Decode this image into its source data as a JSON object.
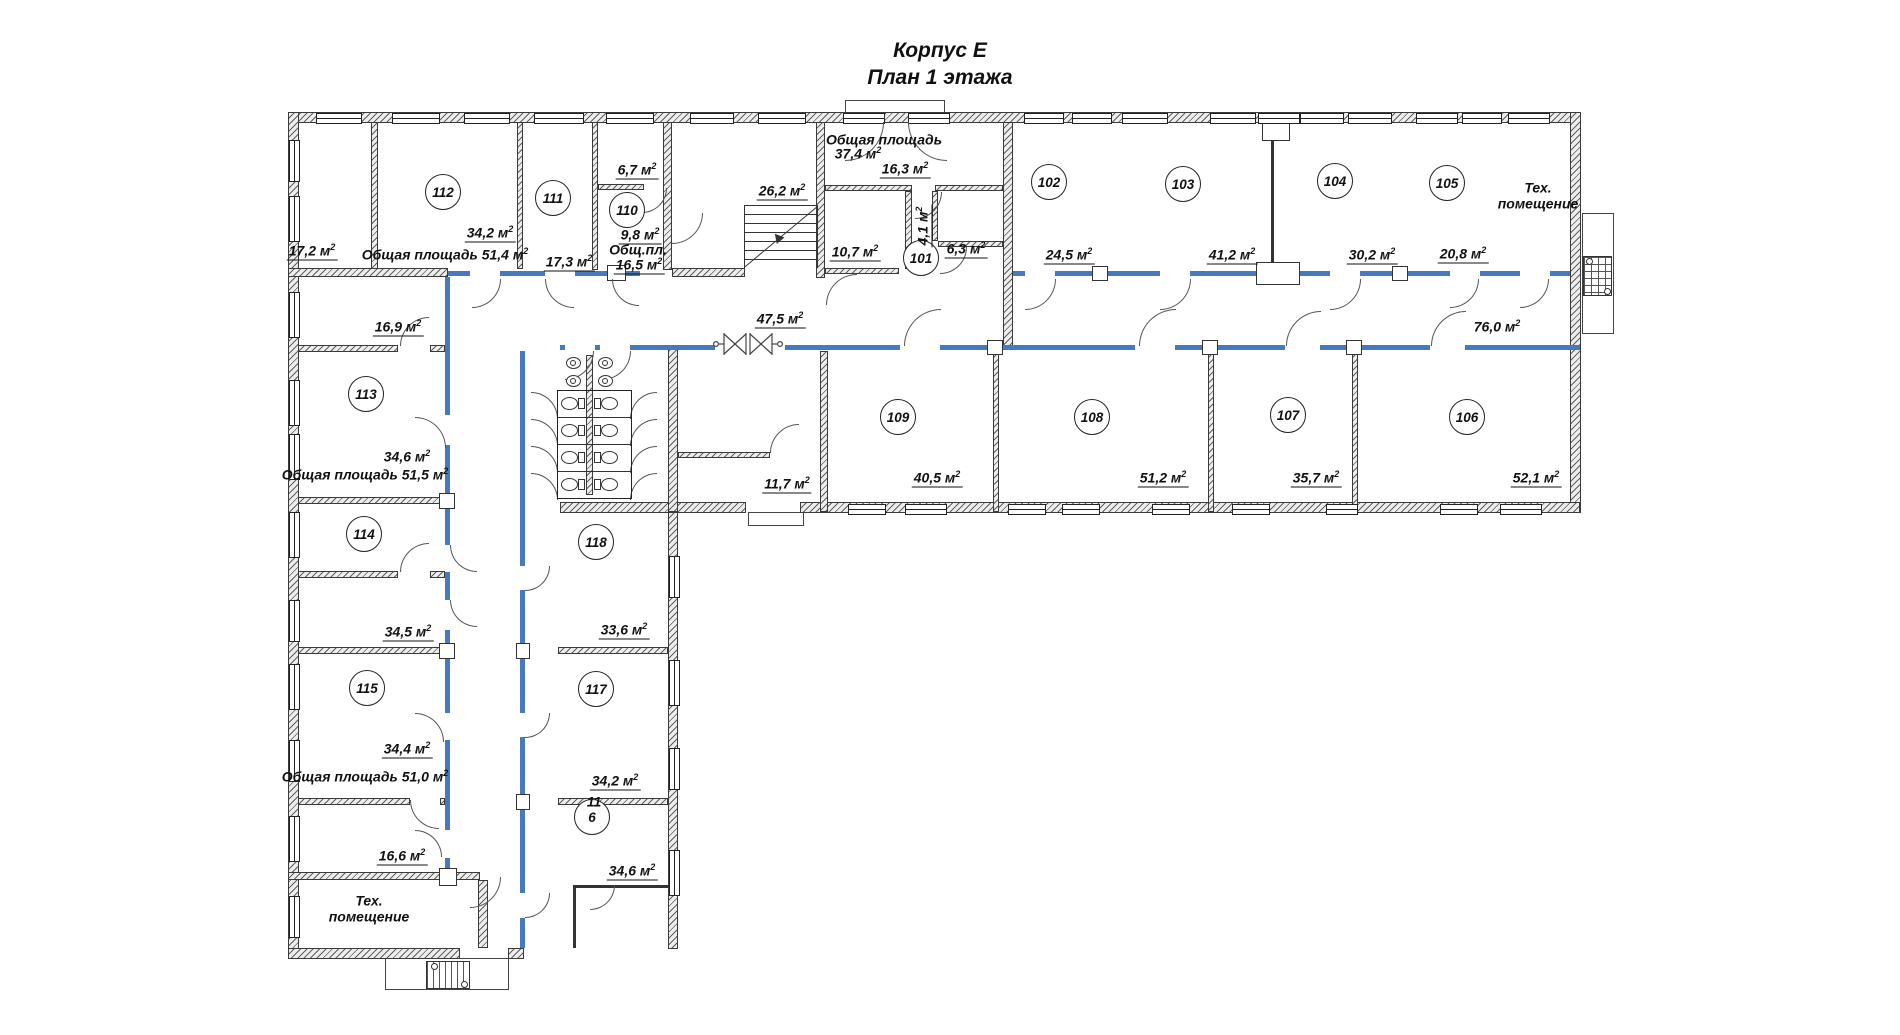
{
  "title": {
    "line1": "Корпус Е",
    "line2": "План 1 этажа"
  },
  "colors": {
    "accent_blue": "#4679bd",
    "line": "#333333",
    "background": "#ffffff"
  },
  "plan": {
    "rooms": [
      [
        "101",
        921,
        258
      ],
      [
        "102",
        1049,
        182
      ],
      [
        "103",
        1183,
        184
      ],
      [
        "104",
        1335,
        181
      ],
      [
        "105",
        1447,
        183
      ],
      [
        "106",
        1467,
        417
      ],
      [
        "107",
        1288,
        415
      ],
      [
        "108",
        1092,
        417
      ],
      [
        "109",
        898,
        417
      ],
      [
        "110",
        627,
        210
      ],
      [
        "111",
        553,
        198
      ],
      [
        "112",
        443,
        192
      ],
      [
        "113",
        366,
        394
      ],
      [
        "114",
        364,
        534
      ],
      [
        "115",
        367,
        688
      ],
      [
        "117",
        596,
        689
      ],
      [
        "118",
        596,
        542
      ],
      [
        "6",
        592,
        817
      ]
    ],
    "labels": [
      {
        "t": "17,2",
        "x": 312,
        "y": 252,
        "u": 1
      },
      {
        "t": "34,2",
        "x": 490,
        "y": 234,
        "u": 1
      },
      {
        "t": "Общая площадь 51,4",
        "x": 445,
        "y": 255
      },
      {
        "t": "6,7",
        "x": 637,
        "y": 171,
        "u": 1
      },
      {
        "t": "9,8",
        "x": 640,
        "y": 236,
        "u": 1
      },
      {
        "t": "Общ.пл.",
        "x": 638,
        "y": 250,
        "m": 0
      },
      {
        "t": "16,5",
        "x": 639,
        "y": 266,
        "u": 1
      },
      {
        "t": "17,3",
        "x": 569,
        "y": 263,
        "u": 1
      },
      {
        "t": "26,2",
        "x": 782,
        "y": 192,
        "u": 1
      },
      {
        "t": "Общая площадь",
        "x": 884,
        "y": 140,
        "m": 0
      },
      {
        "t": "37,4",
        "x": 858,
        "y": 154
      },
      {
        "t": "16,3",
        "x": 905,
        "y": 170,
        "u": 1
      },
      {
        "t": "4,1",
        "x": 924,
        "y": 226,
        "u": 1,
        "rot": 1
      },
      {
        "t": "10,7",
        "x": 855,
        "y": 253,
        "u": 1
      },
      {
        "t": "6,3",
        "x": 966,
        "y": 250,
        "u": 1
      },
      {
        "t": "24,5",
        "x": 1069,
        "y": 256,
        "u": 1
      },
      {
        "t": "41,2",
        "x": 1232,
        "y": 256,
        "u": 1
      },
      {
        "t": "30,2",
        "x": 1372,
        "y": 256,
        "u": 1
      },
      {
        "t": "20,8",
        "x": 1463,
        "y": 255,
        "u": 1
      },
      {
        "t": "Тех.",
        "x": 1538,
        "y": 188,
        "m": 0
      },
      {
        "t": "помещение",
        "x": 1538,
        "y": 204,
        "m": 0
      },
      {
        "t": "47,5",
        "x": 780,
        "y": 320,
        "u": 1
      },
      {
        "t": "76,0",
        "x": 1497,
        "y": 327
      },
      {
        "t": "40,5",
        "x": 937,
        "y": 479,
        "u": 1
      },
      {
        "t": "51,2",
        "x": 1163,
        "y": 479,
        "u": 1
      },
      {
        "t": "35,7",
        "x": 1316,
        "y": 479,
        "u": 1
      },
      {
        "t": "52,1",
        "x": 1536,
        "y": 479,
        "u": 1
      },
      {
        "t": "11,7",
        "x": 787,
        "y": 485,
        "u": 1
      },
      {
        "t": "16,9",
        "x": 398,
        "y": 328,
        "u": 1
      },
      {
        "t": "34,6",
        "x": 407,
        "y": 457
      },
      {
        "t": "Общая площадь 51,5",
        "x": 365,
        "y": 475
      },
      {
        "t": "34,5",
        "x": 408,
        "y": 633,
        "u": 1
      },
      {
        "t": "34,4",
        "x": 407,
        "y": 750,
        "u": 1
      },
      {
        "t": "Общая площадь 51,0",
        "x": 365,
        "y": 777
      },
      {
        "t": "16,6",
        "x": 402,
        "y": 857,
        "u": 1
      },
      {
        "t": "Тех.",
        "x": 369,
        "y": 901,
        "m": 0
      },
      {
        "t": "помещение",
        "x": 369,
        "y": 917,
        "m": 0
      },
      {
        "t": "33,6",
        "x": 624,
        "y": 631,
        "u": 1
      },
      {
        "t": "34,2",
        "x": 615,
        "y": 782,
        "u": 1
      },
      {
        "t": "34,6",
        "x": 632,
        "y": 872,
        "u": 1
      },
      {
        "t": "11",
        "x": 594,
        "y": 802,
        "m": 0
      }
    ],
    "walls": [
      [
        288,
        112,
        1292,
        11
      ],
      [
        288,
        112,
        11,
        846
      ],
      [
        1570,
        112,
        11,
        401
      ],
      [
        560,
        502,
        186,
        11
      ],
      [
        800,
        502,
        780,
        11
      ],
      [
        288,
        948,
        172,
        11
      ],
      [
        508,
        948,
        16,
        11
      ],
      [
        668,
        512,
        10,
        437
      ],
      [
        371,
        122,
        7,
        147
      ],
      [
        517,
        122,
        6,
        147
      ],
      [
        592,
        122,
        6,
        148
      ],
      [
        598,
        184,
        46,
        6
      ],
      [
        663,
        122,
        9,
        148
      ],
      [
        816,
        122,
        9,
        156
      ],
      [
        1003,
        122,
        10,
        224
      ],
      [
        825,
        185,
        87,
        6
      ],
      [
        935,
        185,
        68,
        6
      ],
      [
        905,
        191,
        7,
        78
      ],
      [
        932,
        191,
        6,
        50
      ],
      [
        938,
        241,
        65,
        6
      ],
      [
        825,
        268,
        74,
        6
      ],
      [
        288,
        268,
        160,
        9
      ],
      [
        672,
        268,
        73,
        9
      ],
      [
        668,
        345,
        10,
        167
      ],
      [
        820,
        351,
        8,
        161
      ],
      [
        993,
        351,
        6,
        161
      ],
      [
        1208,
        351,
        6,
        161
      ],
      [
        1352,
        351,
        6,
        161
      ],
      [
        678,
        452,
        92,
        6
      ],
      [
        298,
        345,
        100,
        7
      ],
      [
        430,
        345,
        15,
        7
      ],
      [
        298,
        497,
        147,
        7
      ],
      [
        298,
        571,
        100,
        7
      ],
      [
        430,
        571,
        15,
        7
      ],
      [
        298,
        647,
        147,
        7
      ],
      [
        298,
        798,
        112,
        7
      ],
      [
        440,
        798,
        5,
        7
      ],
      [
        288,
        872,
        192,
        8
      ],
      [
        478,
        880,
        10,
        68
      ],
      [
        586,
        355,
        7,
        140
      ],
      [
        558,
        647,
        110,
        7
      ],
      [
        558,
        798,
        110,
        7
      ]
    ],
    "blue": [
      [
        448,
        271,
        22,
        5
      ],
      [
        500,
        271,
        45,
        5
      ],
      [
        575,
        271,
        65,
        5
      ],
      [
        1013,
        271,
        12,
        5
      ],
      [
        1055,
        271,
        105,
        5
      ],
      [
        1190,
        271,
        140,
        5
      ],
      [
        1360,
        271,
        90,
        5
      ],
      [
        1480,
        271,
        40,
        5
      ],
      [
        1550,
        271,
        20,
        5
      ],
      [
        560,
        345,
        5,
        5
      ],
      [
        595,
        345,
        5,
        5
      ],
      [
        630,
        345,
        85,
        5
      ],
      [
        785,
        345,
        115,
        5
      ],
      [
        940,
        345,
        195,
        5
      ],
      [
        1175,
        345,
        110,
        5
      ],
      [
        1320,
        345,
        110,
        5
      ],
      [
        1465,
        345,
        115,
        5
      ],
      [
        445,
        277,
        5,
        138
      ],
      [
        445,
        445,
        5,
        100
      ],
      [
        445,
        572,
        5,
        28
      ],
      [
        445,
        630,
        5,
        83
      ],
      [
        445,
        740,
        5,
        90
      ],
      [
        445,
        858,
        5,
        14
      ],
      [
        520,
        351,
        5,
        215
      ],
      [
        520,
        590,
        5,
        123
      ],
      [
        520,
        737,
        5,
        156
      ],
      [
        520,
        918,
        5,
        30
      ]
    ],
    "thin": [
      [
        1271,
        138,
        3,
        128
      ],
      [
        573,
        885,
        102,
        3
      ],
      [
        573,
        888,
        3,
        60
      ]
    ],
    "outlines": [
      [
        385,
        958,
        122,
        30
      ],
      [
        1582,
        213,
        30,
        119
      ],
      [
        845,
        100,
        98,
        13
      ],
      [
        748,
        512,
        54,
        12
      ]
    ],
    "boxes": [
      [
        1262,
        122,
        26,
        17
      ],
      [
        1256,
        262,
        42,
        21
      ],
      [
        607,
        265,
        17,
        14
      ],
      [
        439,
        493,
        14,
        14
      ],
      [
        439,
        643,
        14,
        14
      ],
      [
        439,
        868,
        16,
        16
      ],
      [
        516,
        643,
        12,
        14
      ],
      [
        516,
        794,
        12,
        14
      ],
      [
        1092,
        266,
        14,
        13
      ],
      [
        1392,
        266,
        14,
        13
      ],
      [
        987,
        340,
        14,
        13
      ],
      [
        1202,
        340,
        14,
        13
      ],
      [
        1346,
        340,
        14,
        13
      ]
    ],
    "windows_h": [
      [
        316,
        44
      ],
      [
        392,
        46
      ],
      [
        464,
        44
      ],
      [
        534,
        48
      ],
      [
        606,
        46
      ],
      [
        690,
        42
      ],
      [
        758,
        46
      ],
      [
        843,
        40
      ],
      [
        908,
        40
      ],
      [
        1024,
        38
      ],
      [
        1072,
        38
      ],
      [
        1122,
        44
      ],
      [
        1210,
        44
      ],
      [
        1258,
        40
      ],
      [
        1300,
        42
      ],
      [
        1348,
        42
      ],
      [
        1416,
        40
      ],
      [
        1462,
        38
      ],
      [
        1508,
        40
      ]
    ],
    "windows_s": [
      [
        848,
        36
      ],
      [
        905,
        40
      ],
      [
        1008,
        36
      ],
      [
        1062,
        36
      ],
      [
        1152,
        36
      ],
      [
        1232,
        36
      ],
      [
        1326,
        30
      ],
      [
        1440,
        36
      ],
      [
        1500,
        40
      ]
    ],
    "windows_l": [
      [
        140,
        40
      ],
      [
        196,
        44
      ],
      [
        292,
        44
      ],
      [
        380,
        44
      ],
      [
        434,
        44
      ],
      [
        512,
        44
      ],
      [
        600,
        40
      ],
      [
        664,
        44
      ],
      [
        740,
        40
      ],
      [
        816,
        44
      ],
      [
        896,
        40
      ]
    ],
    "windows_e": [
      [
        556,
        40
      ],
      [
        660,
        44
      ],
      [
        748,
        40
      ],
      [
        850,
        44
      ]
    ],
    "arcs": [
      [
        472,
        279,
        28,
        "br"
      ],
      [
        545,
        279,
        28,
        "bl"
      ],
      [
        612,
        279,
        26,
        "bl"
      ],
      [
        1025,
        279,
        30,
        "br"
      ],
      [
        1160,
        279,
        30,
        "br"
      ],
      [
        1330,
        279,
        30,
        "br"
      ],
      [
        1450,
        279,
        28,
        "br"
      ],
      [
        1520,
        279,
        28,
        "br"
      ],
      [
        904,
        309,
        36,
        "tl"
      ],
      [
        1139,
        309,
        36,
        "tl"
      ],
      [
        1286,
        311,
        34,
        "tl"
      ],
      [
        1431,
        311,
        34,
        "tl"
      ],
      [
        565,
        351,
        28,
        "br"
      ],
      [
        602,
        351,
        28,
        "br"
      ],
      [
        415,
        417,
        30,
        "tr"
      ],
      [
        450,
        545,
        26,
        "bl"
      ],
      [
        450,
        600,
        26,
        "bl"
      ],
      [
        415,
        713,
        28,
        "tr"
      ],
      [
        415,
        830,
        26,
        "tr"
      ],
      [
        525,
        566,
        24,
        "br"
      ],
      [
        525,
        713,
        24,
        "br"
      ],
      [
        525,
        893,
        24,
        "br"
      ],
      [
        400,
        543,
        28,
        "tl"
      ],
      [
        410,
        800,
        28,
        "bl"
      ],
      [
        400,
        317,
        28,
        "tl"
      ],
      [
        642,
        188,
        24,
        "br"
      ],
      [
        915,
        192,
        26,
        "br"
      ],
      [
        940,
        247,
        26,
        "br"
      ],
      [
        826,
        274,
        30,
        "tl"
      ],
      [
        672,
        213,
        30,
        "br"
      ],
      [
        770,
        424,
        28,
        "tl"
      ],
      [
        470,
        877,
        30,
        "br"
      ],
      [
        590,
        885,
        24,
        "br"
      ],
      [
        845,
        122,
        38,
        "br"
      ],
      [
        908,
        122,
        38,
        "bl"
      ],
      [
        531,
        392,
        26,
        "tr"
      ],
      [
        531,
        419,
        26,
        "tr"
      ],
      [
        531,
        446,
        26,
        "tr"
      ],
      [
        531,
        473,
        26,
        "tr"
      ],
      [
        630,
        392,
        26,
        "tl"
      ],
      [
        630,
        419,
        26,
        "tl"
      ],
      [
        630,
        446,
        26,
        "tl"
      ],
      [
        630,
        473,
        26,
        "tl"
      ]
    ],
    "stairs": {
      "rect": [
        744,
        205,
        72,
        63
      ],
      "diag_from": [
        744,
        267
      ],
      "diag_angle": -39.8,
      "diag_len": 94,
      "arrow": [
        772,
        228,
        -40
      ]
    },
    "wc": {
      "stall": [
        557,
        390,
        73,
        107
      ],
      "toilets": [
        [
          561,
          397,
          "r"
        ],
        [
          561,
          424,
          "r"
        ],
        [
          561,
          451,
          "r"
        ],
        [
          561,
          478,
          "r"
        ],
        [
          601,
          397,
          "l"
        ],
        [
          601,
          424,
          "l"
        ],
        [
          601,
          451,
          "l"
        ],
        [
          601,
          478,
          "l"
        ]
      ],
      "sinks": [
        [
          566,
          357
        ],
        [
          566,
          375
        ],
        [
          598,
          357
        ],
        [
          598,
          375
        ]
      ]
    },
    "grids": {
      "bottom": [
        426,
        961,
        42,
        26
      ],
      "right": [
        1583,
        256,
        27,
        38
      ],
      "dots": [
        [
          431,
          963
        ],
        [
          461,
          981
        ],
        [
          1586,
          258
        ],
        [
          1604,
          288
        ]
      ]
    },
    "double_door": {
      "x": 712,
      "y": 329,
      "w": 72,
      "h": 30
    }
  }
}
